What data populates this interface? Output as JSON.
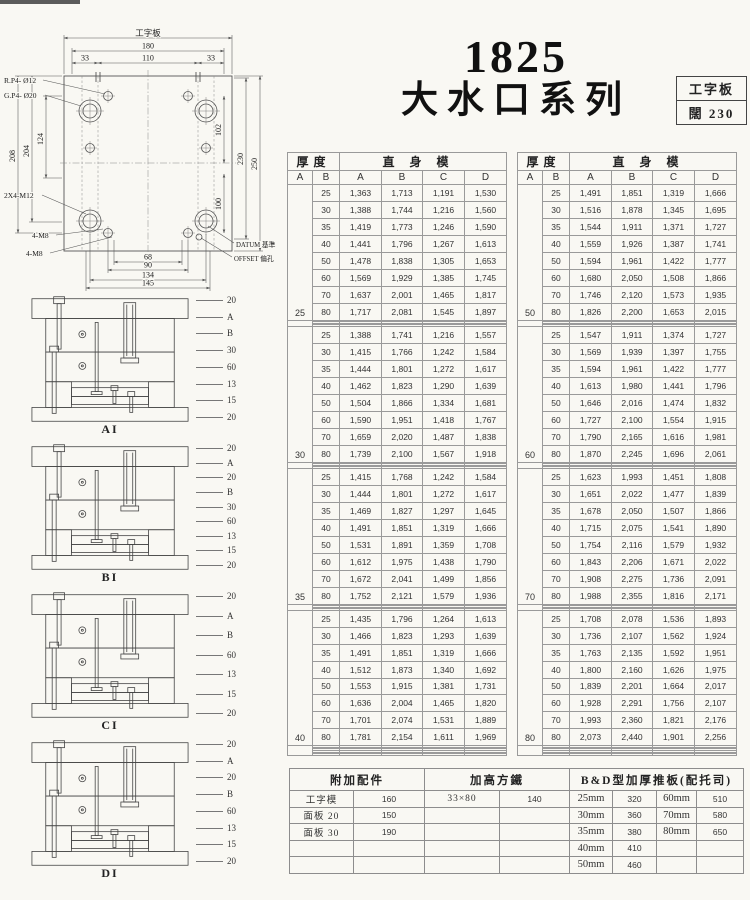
{
  "title": {
    "model": "1825",
    "series": "大水口系列"
  },
  "spec_box": {
    "line1": "工字板",
    "line2": "闊  230"
  },
  "plan": {
    "top_label": "工字板",
    "dims": {
      "w_total": "180",
      "w_left": "33",
      "w_mid": "110",
      "w_right": "33",
      "h_208": "208",
      "h_204": "204",
      "h_124": "124",
      "h_102": "102",
      "h_100": "100",
      "h_230": "230",
      "h_250": "250",
      "b_68": "68",
      "b_90": "90",
      "b_134": "134",
      "b_145": "145"
    },
    "callouts": {
      "rp": "R.P4- Ø12",
      "gp": "G.P4- Ø20",
      "m12": "2X4-M12",
      "m8a": "4-M8",
      "m8b": "4-M8",
      "datum": "DATUM 基準",
      "offset": "OFFSET 偏孔"
    }
  },
  "sections": [
    {
      "caption": "AI",
      "labels": [
        "20",
        "A",
        "B",
        "30",
        "60",
        "13",
        "15",
        "20"
      ]
    },
    {
      "caption": "BI",
      "labels": [
        "20",
        "A",
        "20",
        "B",
        "30",
        "60",
        "13",
        "15",
        "20"
      ]
    },
    {
      "caption": "CI",
      "labels": [
        "20",
        "A",
        "B",
        "60",
        "13",
        "15",
        "20"
      ]
    },
    {
      "caption": "DI",
      "labels": [
        "20",
        "A",
        "20",
        "B",
        "60",
        "13",
        "15",
        "20"
      ]
    }
  ],
  "main_table": {
    "header": {
      "thickness": "厚度",
      "body": "直身模",
      "cols": [
        "A",
        "B",
        "A",
        "B",
        "C",
        "D"
      ]
    },
    "left_blocks": [
      {
        "a": "25",
        "empty": 4,
        "rows": [
          [
            "25",
            "1,363",
            "1,713",
            "1,191",
            "1,530"
          ],
          [
            "30",
            "1,388",
            "1,744",
            "1,216",
            "1,560"
          ],
          [
            "35",
            "1,419",
            "1,773",
            "1,246",
            "1,590"
          ],
          [
            "40",
            "1,441",
            "1,796",
            "1,267",
            "1,613"
          ],
          [
            "50",
            "1,478",
            "1,838",
            "1,305",
            "1,653"
          ],
          [
            "60",
            "1,569",
            "1,929",
            "1,385",
            "1,745"
          ],
          [
            "70",
            "1,637",
            "2,001",
            "1,465",
            "1,817"
          ],
          [
            "80",
            "1,717",
            "2,081",
            "1,545",
            "1,897"
          ]
        ]
      },
      {
        "a": "30",
        "empty": 4,
        "rows": [
          [
            "25",
            "1,388",
            "1,741",
            "1,216",
            "1,557"
          ],
          [
            "30",
            "1,415",
            "1,766",
            "1,242",
            "1,584"
          ],
          [
            "35",
            "1,444",
            "1,801",
            "1,272",
            "1,617"
          ],
          [
            "40",
            "1,462",
            "1,823",
            "1,290",
            "1,639"
          ],
          [
            "50",
            "1,504",
            "1,866",
            "1,334",
            "1,681"
          ],
          [
            "60",
            "1,590",
            "1,951",
            "1,418",
            "1,767"
          ],
          [
            "70",
            "1,659",
            "2,020",
            "1,487",
            "1,838"
          ],
          [
            "80",
            "1,739",
            "2,100",
            "1,567",
            "1,918"
          ]
        ]
      },
      {
        "a": "35",
        "empty": 4,
        "rows": [
          [
            "25",
            "1,415",
            "1,768",
            "1,242",
            "1,584"
          ],
          [
            "30",
            "1,444",
            "1,801",
            "1,272",
            "1,617"
          ],
          [
            "35",
            "1,469",
            "1,827",
            "1,297",
            "1,645"
          ],
          [
            "40",
            "1,491",
            "1,851",
            "1,319",
            "1,666"
          ],
          [
            "50",
            "1,531",
            "1,891",
            "1,359",
            "1,708"
          ],
          [
            "60",
            "1,612",
            "1,975",
            "1,438",
            "1,790"
          ],
          [
            "70",
            "1,672",
            "2,041",
            "1,499",
            "1,856"
          ],
          [
            "80",
            "1,752",
            "2,121",
            "1,579",
            "1,936"
          ]
        ]
      },
      {
        "a": "40",
        "empty": 6,
        "rows": [
          [
            "25",
            "1,435",
            "1,796",
            "1,264",
            "1,613"
          ],
          [
            "30",
            "1,466",
            "1,823",
            "1,293",
            "1,639"
          ],
          [
            "35",
            "1,491",
            "1,851",
            "1,319",
            "1,666"
          ],
          [
            "40",
            "1,512",
            "1,873",
            "1,340",
            "1,692"
          ],
          [
            "50",
            "1,553",
            "1,915",
            "1,381",
            "1,731"
          ],
          [
            "60",
            "1,636",
            "2,004",
            "1,465",
            "1,820"
          ],
          [
            "70",
            "1,701",
            "2,074",
            "1,531",
            "1,889"
          ],
          [
            "80",
            "1,781",
            "2,154",
            "1,611",
            "1,969"
          ]
        ]
      }
    ],
    "right_blocks": [
      {
        "a": "50",
        "empty": 4,
        "rows": [
          [
            "25",
            "1,491",
            "1,851",
            "1,319",
            "1,666"
          ],
          [
            "30",
            "1,516",
            "1,878",
            "1,345",
            "1,695"
          ],
          [
            "35",
            "1,544",
            "1,911",
            "1,371",
            "1,727"
          ],
          [
            "40",
            "1,559",
            "1,926",
            "1,387",
            "1,741"
          ],
          [
            "50",
            "1,594",
            "1,961",
            "1,422",
            "1,777"
          ],
          [
            "60",
            "1,680",
            "2,050",
            "1,508",
            "1,866"
          ],
          [
            "70",
            "1,746",
            "2,120",
            "1,573",
            "1,935"
          ],
          [
            "80",
            "1,826",
            "2,200",
            "1,653",
            "2,015"
          ]
        ]
      },
      {
        "a": "60",
        "empty": 4,
        "rows": [
          [
            "25",
            "1,547",
            "1,911",
            "1,374",
            "1,727"
          ],
          [
            "30",
            "1,569",
            "1,939",
            "1,397",
            "1,755"
          ],
          [
            "35",
            "1,594",
            "1,961",
            "1,422",
            "1,777"
          ],
          [
            "40",
            "1,613",
            "1,980",
            "1,441",
            "1,796"
          ],
          [
            "50",
            "1,646",
            "2,016",
            "1,474",
            "1,832"
          ],
          [
            "60",
            "1,727",
            "2,100",
            "1,554",
            "1,915"
          ],
          [
            "70",
            "1,790",
            "2,165",
            "1,616",
            "1,981"
          ],
          [
            "80",
            "1,870",
            "2,245",
            "1,696",
            "2,061"
          ]
        ]
      },
      {
        "a": "70",
        "empty": 4,
        "rows": [
          [
            "25",
            "1,623",
            "1,993",
            "1,451",
            "1,808"
          ],
          [
            "30",
            "1,651",
            "2,022",
            "1,477",
            "1,839"
          ],
          [
            "35",
            "1,678",
            "2,050",
            "1,507",
            "1,866"
          ],
          [
            "40",
            "1,715",
            "2,075",
            "1,541",
            "1,890"
          ],
          [
            "50",
            "1,754",
            "2,116",
            "1,579",
            "1,932"
          ],
          [
            "60",
            "1,843",
            "2,206",
            "1,671",
            "2,022"
          ],
          [
            "70",
            "1,908",
            "2,275",
            "1,736",
            "2,091"
          ],
          [
            "80",
            "1,988",
            "2,355",
            "1,816",
            "2,171"
          ]
        ]
      },
      {
        "a": "80",
        "empty": 6,
        "rows": [
          [
            "25",
            "1,708",
            "2,078",
            "1,536",
            "1,893"
          ],
          [
            "30",
            "1,736",
            "2,107",
            "1,562",
            "1,924"
          ],
          [
            "35",
            "1,763",
            "2,135",
            "1,592",
            "1,951"
          ],
          [
            "40",
            "1,800",
            "2,160",
            "1,626",
            "1,975"
          ],
          [
            "50",
            "1,839",
            "2,201",
            "1,664",
            "2,017"
          ],
          [
            "60",
            "1,928",
            "2,291",
            "1,756",
            "2,107"
          ],
          [
            "70",
            "1,993",
            "2,360",
            "1,821",
            "2,176"
          ],
          [
            "80",
            "2,073",
            "2,440",
            "1,901",
            "2,256"
          ]
        ]
      }
    ]
  },
  "bottom_table": {
    "accessories": {
      "title": "附加配件",
      "rows": [
        [
          "工字模",
          "160"
        ],
        [
          "面板 20",
          "150"
        ],
        [
          "面板 30",
          "190"
        ]
      ]
    },
    "riser": {
      "title": "加高方鐵",
      "rows": [
        [
          "33×80",
          "140"
        ]
      ]
    },
    "bd": {
      "title": "B&D型加厚推板(配托司)",
      "rows": [
        [
          "25mm",
          "320",
          "60mm",
          "510"
        ],
        [
          "30mm",
          "360",
          "70mm",
          "580"
        ],
        [
          "35mm",
          "380",
          "80mm",
          "650"
        ],
        [
          "40mm",
          "410",
          "",
          ""
        ],
        [
          "50mm",
          "460",
          "",
          ""
        ]
      ]
    }
  }
}
